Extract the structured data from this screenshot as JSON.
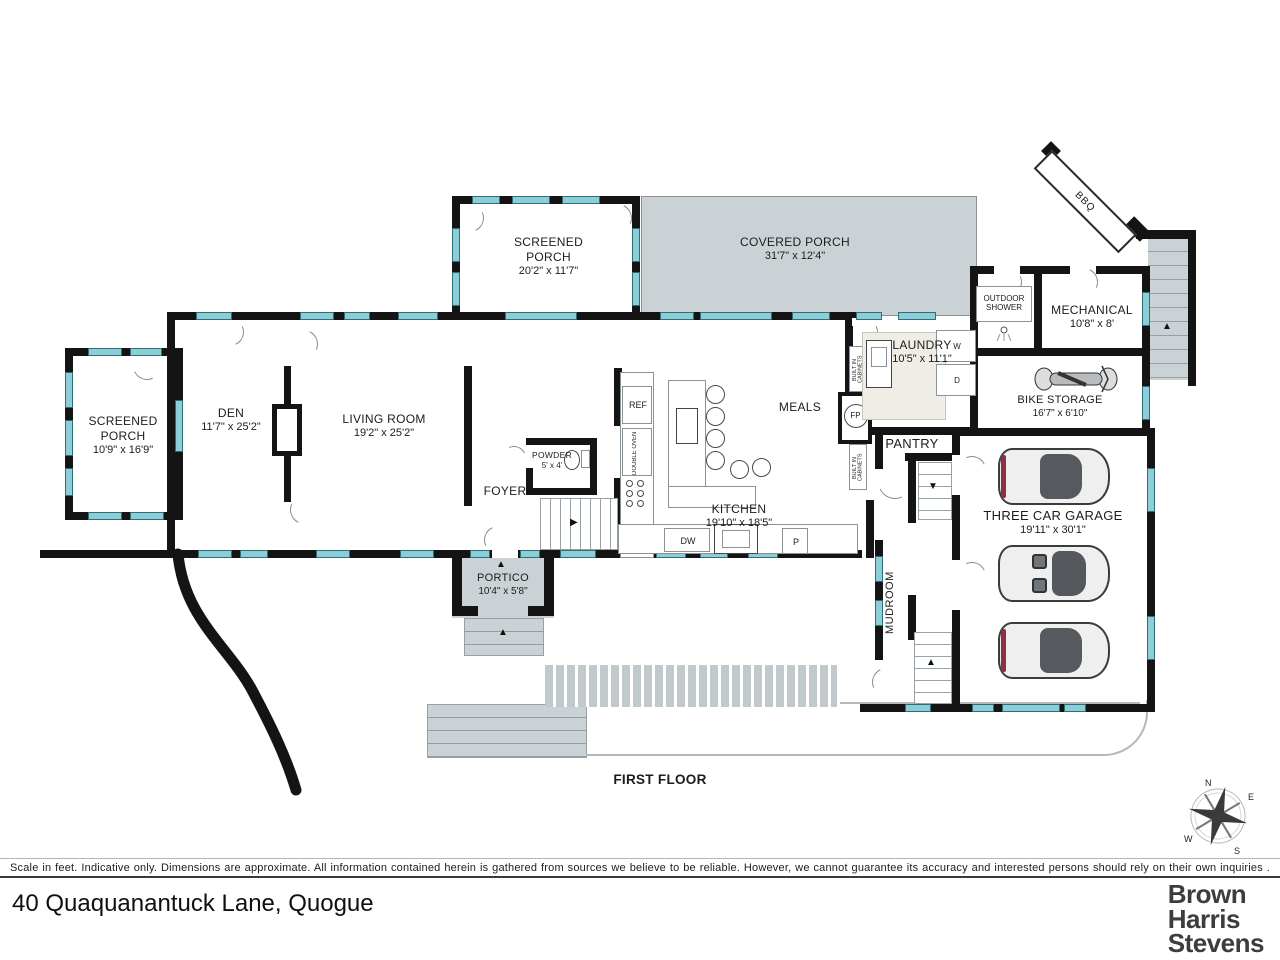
{
  "title": {
    "floor": "FIRST FLOOR",
    "address": "40 Quaquanantuck Lane, Quogue"
  },
  "brand": {
    "lines": [
      "Brown",
      "Harris",
      "Stevens"
    ]
  },
  "footer": {
    "disclaimer": "Scale in feet. Indicative only. Dimensions are approximate. All information contained herein is gathered from sources we believe to be reliable. However, we cannot guarantee its accuracy and interested persons should rely on their own  inquiries ."
  },
  "rooms": {
    "screened_porch_west": {
      "name": "SCREENED PORCH",
      "dims": "10'9\" x 16'9\""
    },
    "den": {
      "name": "DEN",
      "dims": "11'7\" x 25'2\""
    },
    "living_room": {
      "name": "LIVING ROOM",
      "dims": "19'2\" x 25'2\""
    },
    "screened_porch_north": {
      "name": "SCREENED PORCH",
      "dims": "20'2\" x 11'7\""
    },
    "covered_porch": {
      "name": "COVERED PORCH",
      "dims": "31'7\" x 12'4\""
    },
    "laundry": {
      "name": "LAUNDRY",
      "dims": "10'5\" x 11'1\""
    },
    "outdoor_shower": {
      "name": "OUTDOOR SHOWER"
    },
    "mechanical": {
      "name": "MECHANICAL",
      "dims": "10'8\" x 8'"
    },
    "bike_storage": {
      "name": "BIKE STORAGE",
      "dims": "16'7\" x 6'10\""
    },
    "meals": {
      "name": "MEALS"
    },
    "kitchen": {
      "name": "KITCHEN",
      "dims": "19'10\" x 18'5\""
    },
    "foyer": {
      "name": "FOYER"
    },
    "powder": {
      "name": "POWDER",
      "dims": "5' x 4'"
    },
    "portico": {
      "name": "PORTICO",
      "dims": "10'4\" x 5'8\""
    },
    "pantry": {
      "name": "PANTRY"
    },
    "mudroom": {
      "name": "MUDROOM"
    },
    "garage": {
      "name": "THREE CAR GARAGE",
      "dims": "19'11\" x 30'1\""
    },
    "bbq": {
      "name": "BBQ"
    }
  },
  "fixtures": {
    "ref": "REF",
    "double_oven": "DOUBLE OVEN",
    "dw": "DW",
    "p": "P",
    "w": "W",
    "d": "D",
    "fp": "FP",
    "built_in_cabinets": "BUILT IN CABINETS"
  },
  "compass": {
    "n": "N",
    "e": "E",
    "s": "S",
    "w": "W"
  },
  "icons": {
    "up": "▲",
    "right": "▶",
    "down": "▼"
  },
  "colors": {
    "wall": "#141414",
    "window": "#8ccdd8",
    "porch_fill": "#cbd2d6"
  }
}
